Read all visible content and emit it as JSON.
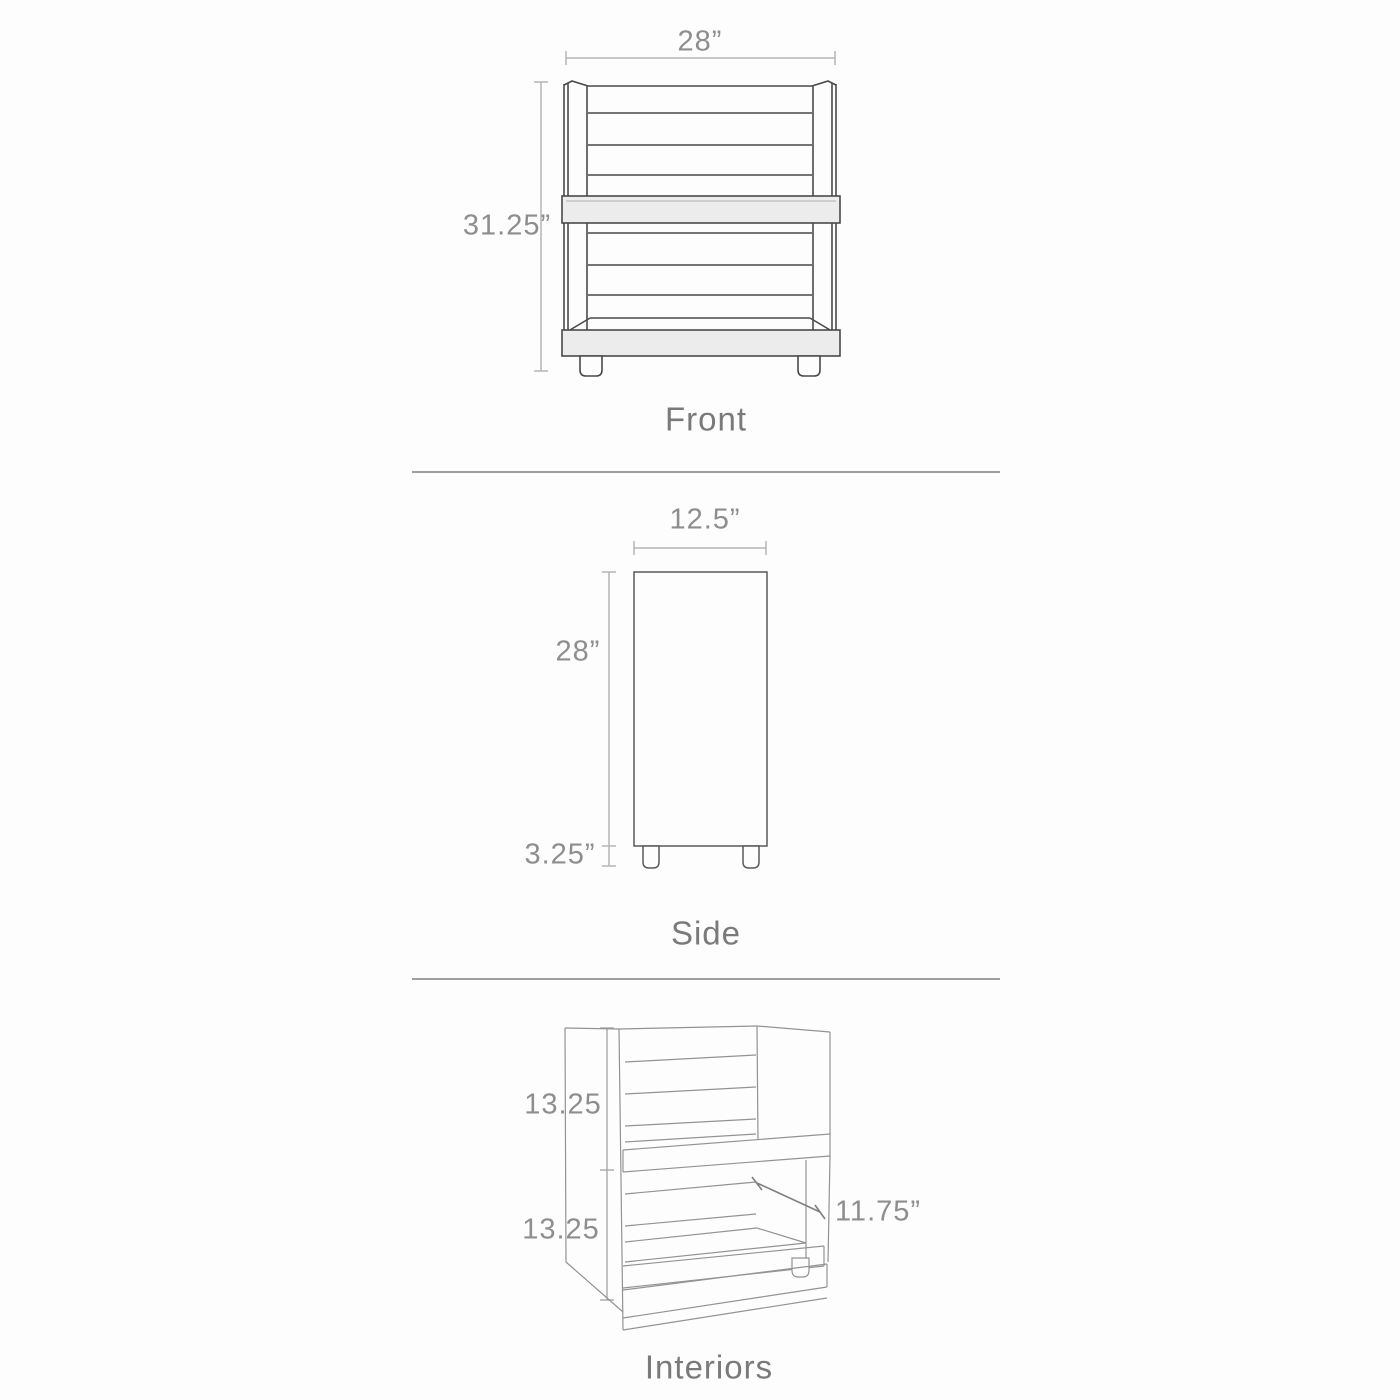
{
  "colors": {
    "background": "#fdfdfd",
    "dimension_line": "#b5b5b5",
    "front_side_outline": "#4a4a4a",
    "interiors_outline": "#939393",
    "panel_fill": "#ececec",
    "divider": "#9e9e9e",
    "dimension_text": "#8e8e8e",
    "caption_text": "#7a7a7a"
  },
  "views": {
    "front": {
      "caption": "Front",
      "width_label": "28”",
      "height_label": "31.25”"
    },
    "side": {
      "caption": "Side",
      "width_label": "12.5”",
      "height_label": "28”",
      "leg_height_label": "3.25”"
    },
    "interiors": {
      "caption": "Interiors",
      "upper_interior_label": "13.25",
      "lower_interior_label": "13.25",
      "depth_label": "11.75”"
    }
  }
}
